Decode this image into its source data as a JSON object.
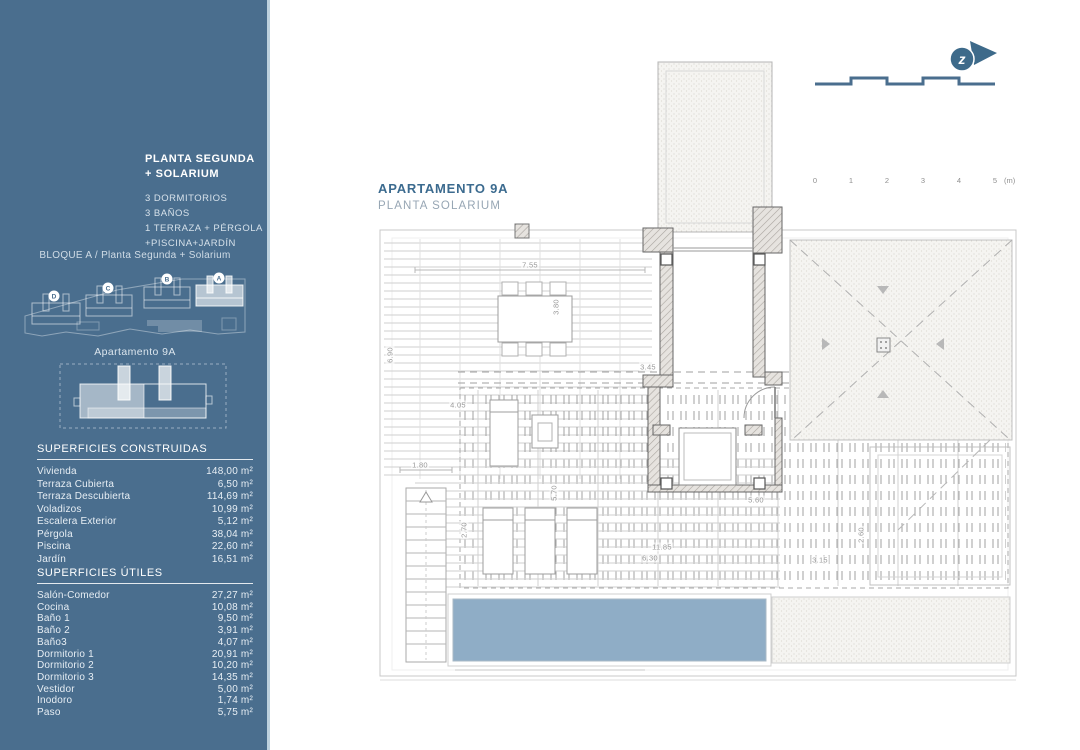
{
  "sidebar": {
    "title": "PLANTA SEGUNDA + SOLARIUM",
    "features": [
      "3 DORMITORIOS",
      "3 BAÑOS",
      "1 TERRAZA + PÉRGOLA",
      "+PISCINA+JARDÍN"
    ],
    "block_caption": "BLOQUE A / Planta Segunda + Solarium",
    "site_plan": {
      "blocks": [
        "D",
        "C",
        "B",
        "A"
      ],
      "highlighted_block": "A"
    },
    "unit_caption": "Apartamento 9A",
    "surfaces_built": {
      "title": "SUPERFICIES CONSTRUIDAS",
      "rows": [
        {
          "label": "Vivienda",
          "value": "148,00 m²"
        },
        {
          "label": "Terraza Cubierta",
          "value": "6,50 m²"
        },
        {
          "label": "Terraza Descubierta",
          "value": "114,69 m²"
        },
        {
          "label": "Voladizos",
          "value": "10,99 m²"
        },
        {
          "label": "Escalera Exterior",
          "value": "5,12 m²"
        },
        {
          "label": "Pérgola",
          "value": "38,04 m²"
        },
        {
          "label": "Piscina",
          "value": "22,60 m²"
        },
        {
          "label": "Jardín",
          "value": "16,51 m²"
        }
      ]
    },
    "surfaces_useful": {
      "title": "SUPERFICIES ÚTILES",
      "rows": [
        {
          "label": "Salón-Comedor",
          "value": "27,27 m²"
        },
        {
          "label": "Cocina",
          "value": "10,08 m²"
        },
        {
          "label": "Baño 1",
          "value": "9,50 m²"
        },
        {
          "label": "Baño 2",
          "value": "3,91 m²"
        },
        {
          "label": "Baño3",
          "value": "4,07 m²"
        },
        {
          "label": "Dormitorio 1",
          "value": "20,91 m²"
        },
        {
          "label": "Dormitorio 2",
          "value": "10,20 m²"
        },
        {
          "label": "Dormitorio 3",
          "value": "14,35 m²"
        },
        {
          "label": "Vestidor",
          "value": "5,00 m²"
        },
        {
          "label": "Inodoro",
          "value": "1,74 m²"
        },
        {
          "label": "Paso",
          "value": "5,75 m²"
        }
      ]
    }
  },
  "plan": {
    "title": "APARTAMENTO 9A",
    "subtitle": "PLANTA SOLARIUM",
    "dimensions": [
      {
        "text": "7.55",
        "x": 152,
        "y": 207,
        "vertical": false
      },
      {
        "text": "3.80",
        "x": 178,
        "y": 249,
        "vertical": true
      },
      {
        "text": "6.90",
        "x": 12,
        "y": 297,
        "vertical": true
      },
      {
        "text": "3.45",
        "x": 270,
        "y": 309,
        "vertical": false
      },
      {
        "text": "4.05",
        "x": 80,
        "y": 347,
        "vertical": false
      },
      {
        "text": "1.80",
        "x": 42,
        "y": 407,
        "vertical": false
      },
      {
        "text": "2.70",
        "x": 86,
        "y": 472,
        "vertical": true
      },
      {
        "text": "5.70",
        "x": 176,
        "y": 435,
        "vertical": true
      },
      {
        "text": "5.60",
        "x": 378,
        "y": 442,
        "vertical": false
      },
      {
        "text": "11.85",
        "x": 284,
        "y": 489,
        "vertical": false
      },
      {
        "text": "6.30",
        "x": 272,
        "y": 500,
        "vertical": false
      },
      {
        "text": "2.60",
        "x": 483,
        "y": 477,
        "vertical": true
      },
      {
        "text": "3.15",
        "x": 442,
        "y": 502,
        "vertical": false
      }
    ]
  },
  "scalebar": {
    "labels": [
      "0",
      "1",
      "2",
      "3",
      "4",
      "5"
    ],
    "unit": "(m)",
    "meter_px": 36
  },
  "compass": {
    "letter": "z"
  },
  "colors": {
    "sidebar": "#4a6e8e",
    "accent": "#3c6b8f",
    "subtitle": "#97a6b4",
    "pool": "#8fadc6",
    "brand": "#3d6a8a"
  }
}
